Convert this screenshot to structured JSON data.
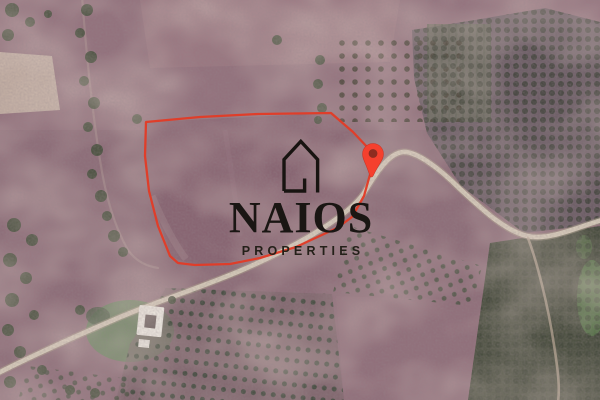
{
  "brand": {
    "name": "NAIOS",
    "tagline": "PROPERTIES",
    "icon": "house-outline-icon",
    "text_color": "#1a1613"
  },
  "map": {
    "type": "satellite",
    "parcel_boundary": {
      "color": "#e23b26",
      "points": "146,122 200,117 258,114 331,113 353,132 369,149 371,171 364,196 352,217 337,228 311,240 296,247 260,258 230,264 195,265 178,263 170,256 158,226 149,191 145,156"
    },
    "marker": {
      "icon": "location-pin-icon",
      "color": "#f5402e",
      "inner_color": "#8e2c20",
      "transform": "translate(373,154) rotate(4)"
    },
    "palette": {
      "field": "#8e6e79",
      "field_light": "#9c7883",
      "road": "#d3c8b7",
      "trees": "#49523f",
      "forest": "#4e5243",
      "lawn": "#68805f",
      "building": "#ebe8e1"
    }
  }
}
